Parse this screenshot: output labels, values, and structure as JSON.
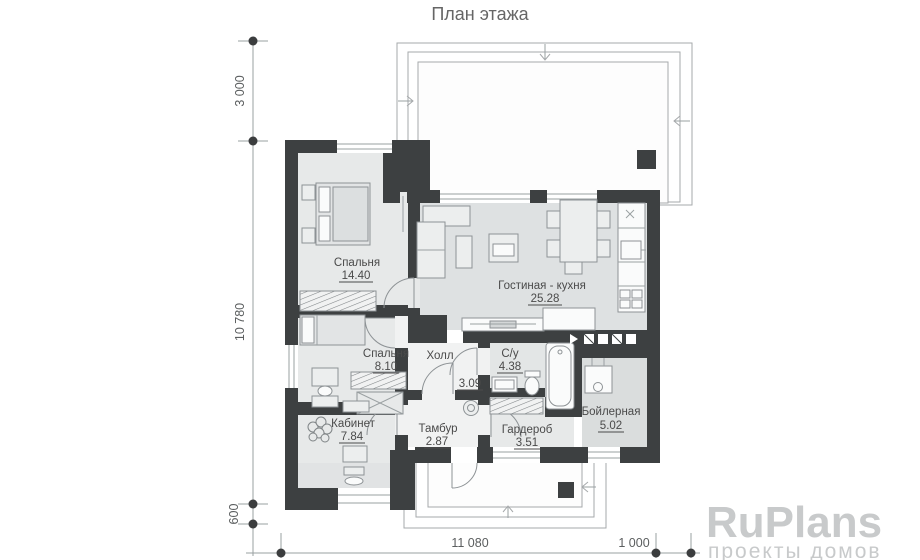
{
  "title": "План этажа",
  "rooms": [
    {
      "name": "Спальня",
      "area": "14.40"
    },
    {
      "name": "Гостиная - кухня",
      "area": "25.28"
    },
    {
      "name": "Спальня",
      "area": "8.10"
    },
    {
      "name": "Холл",
      "area": "3.09"
    },
    {
      "name": "С/у",
      "area": "4.38"
    },
    {
      "name": "Кабинет",
      "area": "7.84"
    },
    {
      "name": "Тамбур",
      "area": "2.87"
    },
    {
      "name": "Гардероб",
      "area": "3.51"
    },
    {
      "name": "Бойлерная",
      "area": "5.02"
    }
  ],
  "dimensions": {
    "left_vertical": [
      "3 000",
      "10 780",
      "600"
    ],
    "bottom_horizontal": [
      "11 080",
      "1 000"
    ]
  },
  "logo": {
    "brand": "RuPlans",
    "tagline": "проекты домов"
  },
  "colors": {
    "wall": "#3d4041",
    "room_fill": "#e7e9e9",
    "living_fill": "#dee1e2",
    "bath_fill": "#e3e6e6",
    "boiler_fill": "#dadddd",
    "hall_fill": "#f1f2f2",
    "outline": "#9aa0a2",
    "label_text": "#4a4a4a",
    "logo_text": "#c8cacb"
  }
}
